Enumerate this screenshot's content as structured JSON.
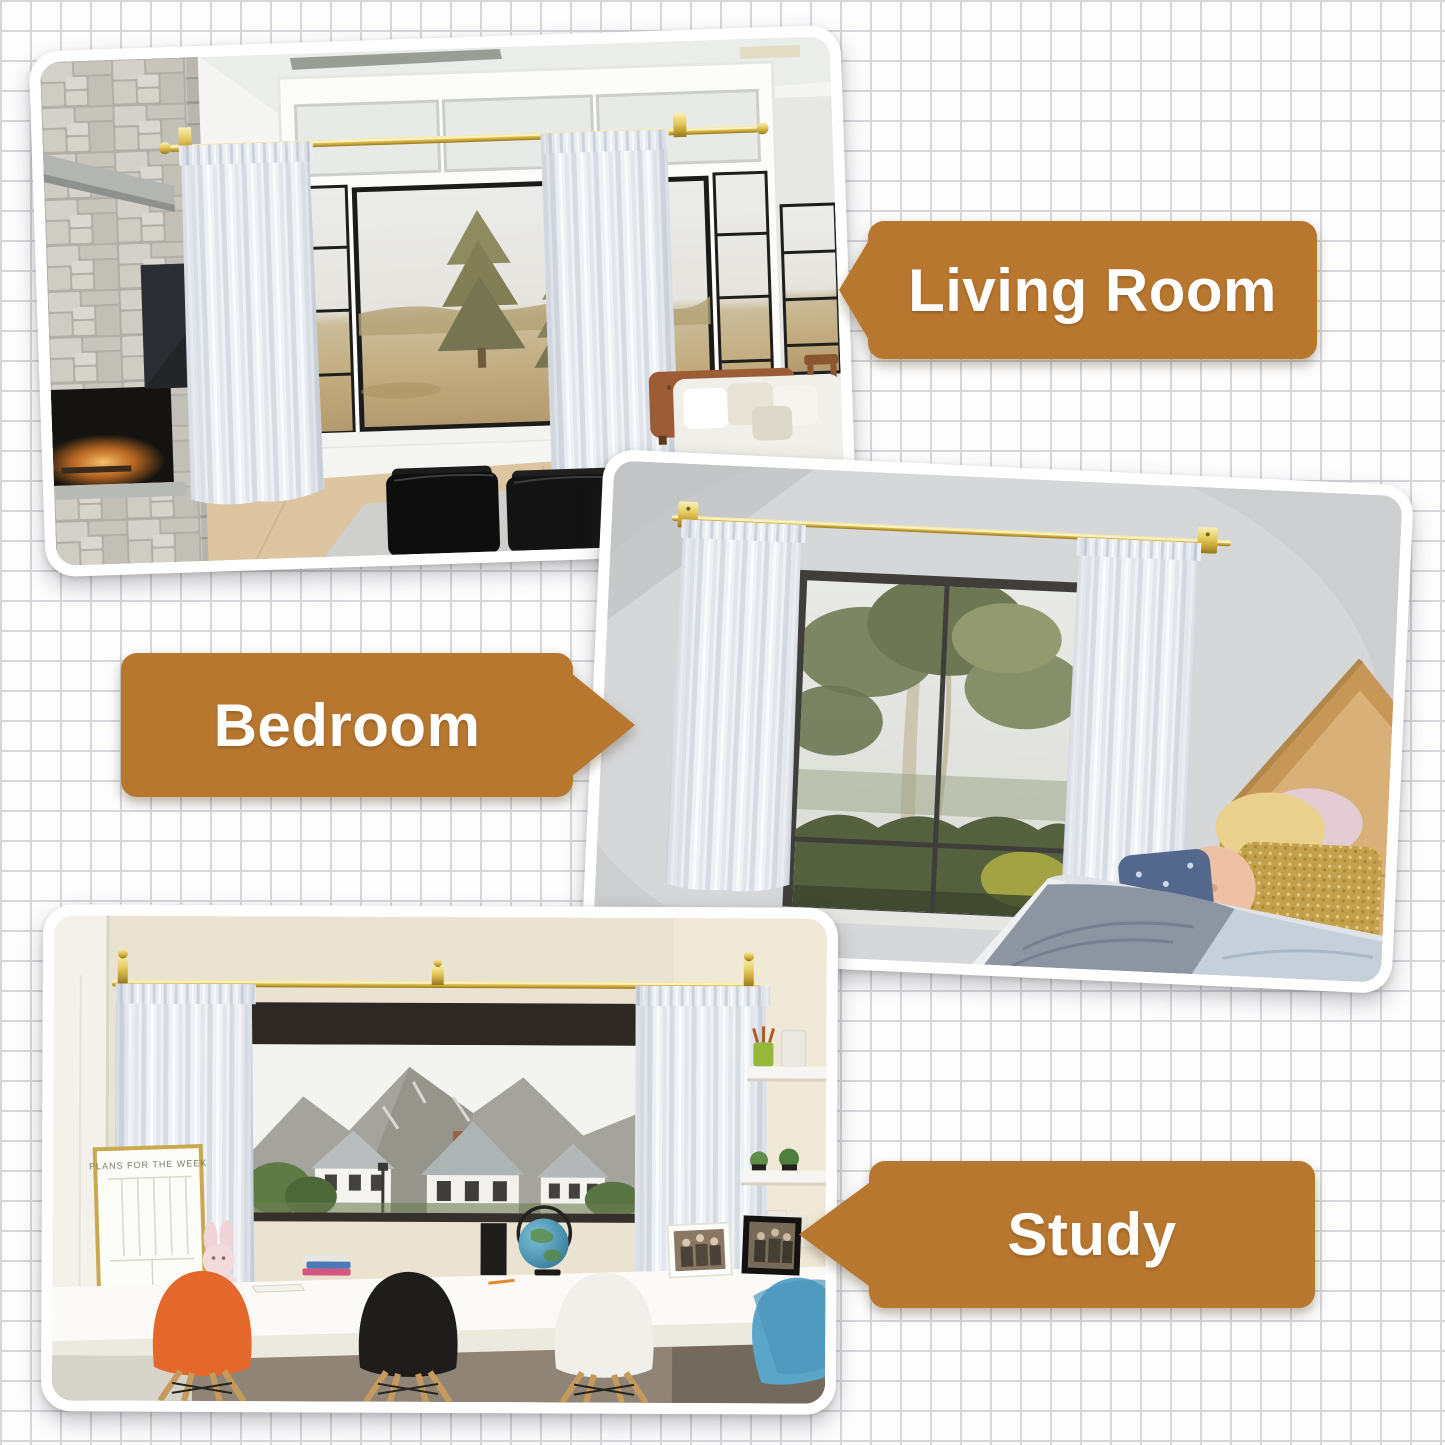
{
  "canvas": {
    "background": "#fdfdfe",
    "grid_line_color": "#d5d7db",
    "grid_cell_px": 30
  },
  "theme": {
    "callout_bg": "#b8772f",
    "callout_text_color": "#ffffff",
    "photo_frame_color": "#ffffff",
    "curtain_rod_gold": "#d9b845",
    "curtain_color": "#eef1f5"
  },
  "callouts": {
    "living_room": {
      "label": "Living Room",
      "arrow_direction": "left"
    },
    "bedroom": {
      "label": "Bedroom",
      "arrow_direction": "right"
    },
    "study": {
      "label": "Study",
      "arrow_direction": "left"
    }
  },
  "study_scene": {
    "planner_board_title": "PLANS FOR THE WEEK"
  }
}
